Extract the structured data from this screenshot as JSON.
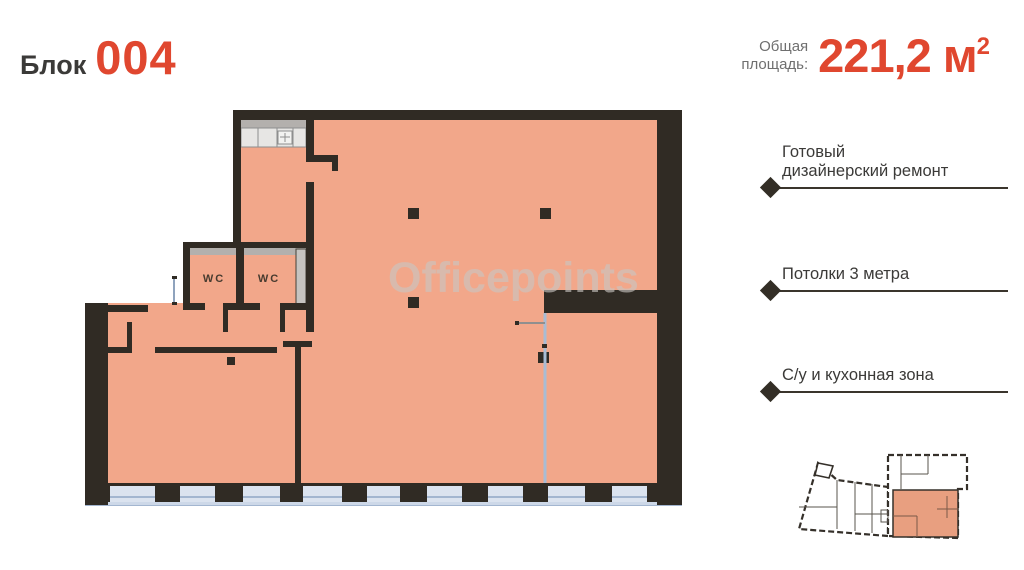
{
  "header": {
    "block_label": "Блок",
    "block_number": "004",
    "area_label_line1": "Общая",
    "area_label_line2": "площадь:",
    "area_value": "221,2",
    "area_unit": "м",
    "area_sup": "2"
  },
  "features": [
    {
      "lines": [
        "Готовый",
        "дизайнерский ремонт"
      ]
    },
    {
      "lines": [
        "Потолки 3 метра"
      ]
    },
    {
      "lines": [
        "С/у и кухонная зона"
      ]
    }
  ],
  "plan": {
    "watermark": "Officepoints",
    "wc_labels": [
      "WC",
      "WC"
    ]
  },
  "colors": {
    "accent": "#E0472F",
    "ink": "#3B3A38",
    "gray-label": "#6F6F6F",
    "wall": "#302B24",
    "floor": "#F2A78A",
    "glass": "#DBE3EF",
    "frame": "#A3B6D0",
    "counter-gray": "#B3B0AD",
    "counter-light": "#E7E6E4",
    "shaft": "#C6C4C1",
    "partition": "#A9BCD4",
    "watermark": "#C9C6C3",
    "minimap-fill": "#E89F80"
  }
}
